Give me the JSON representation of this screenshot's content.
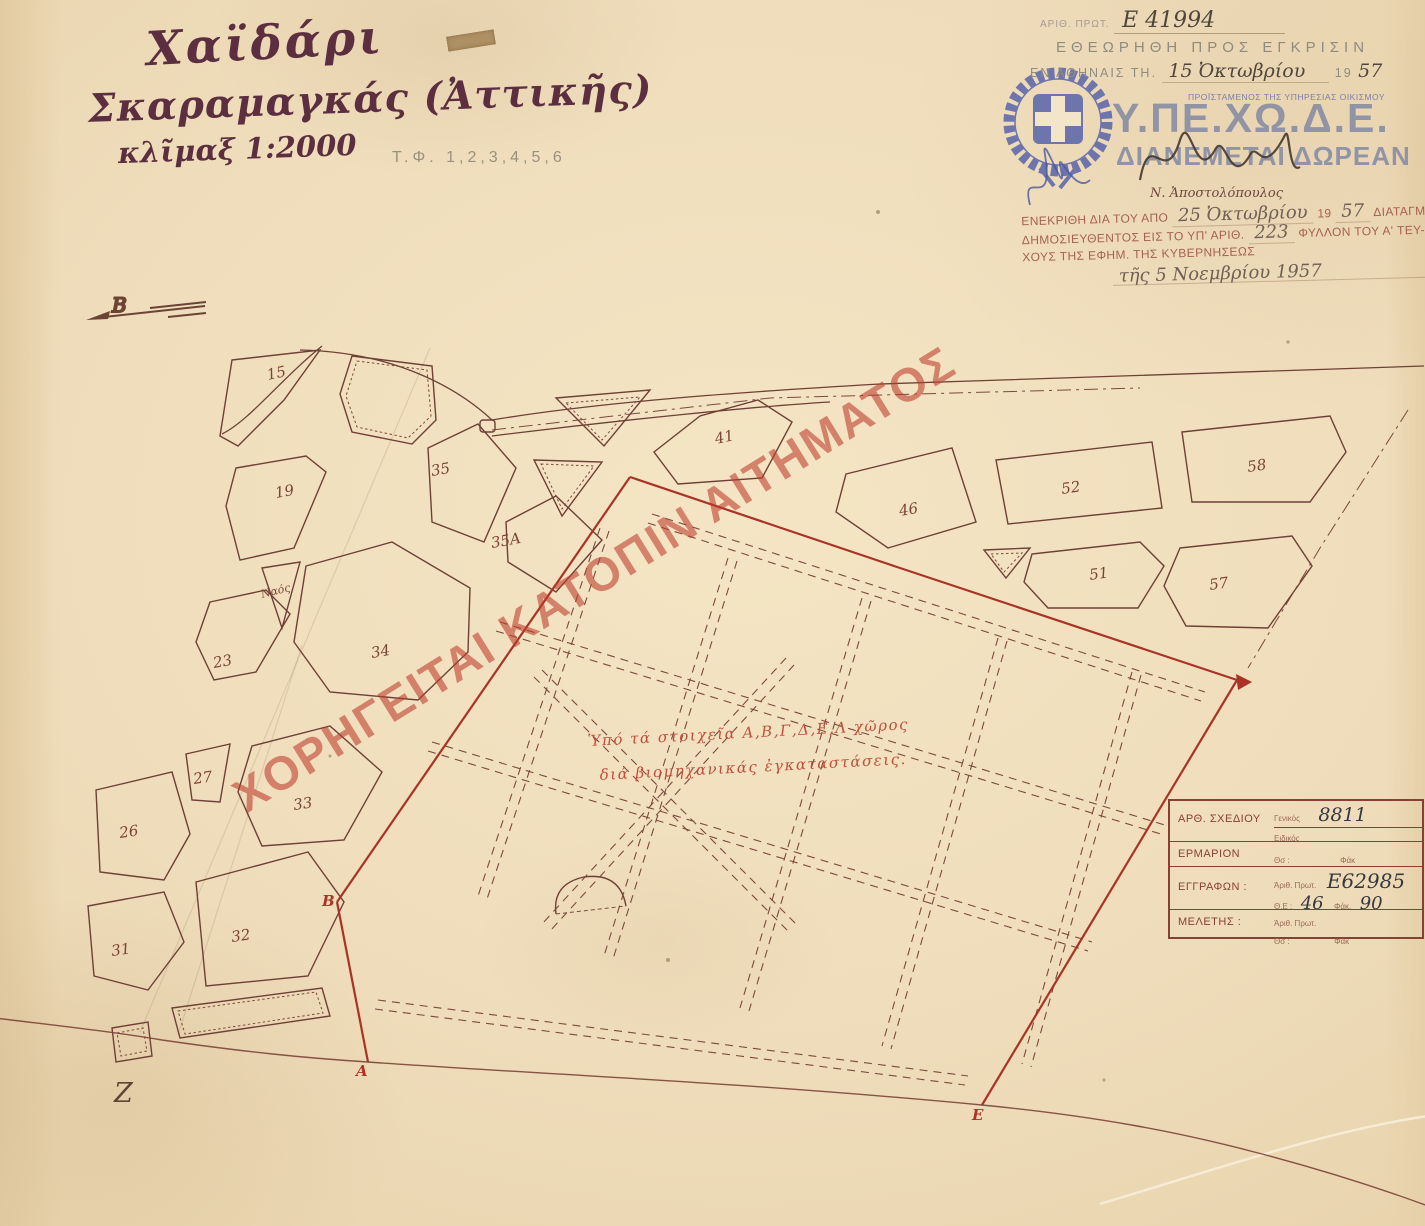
{
  "header": {
    "title_line1": "Χαϊδάρι",
    "title_line2": "Σκαραμαγκάς (Ἀττικῆς)",
    "scale": "κλῖμαξ 1:2000",
    "sheets": "Τ.Φ. 1,2,3,4,5,6"
  },
  "protocol": {
    "number_label": "ΑΡΙΘ. ΠΡΩΤ.",
    "number": "Ε 41994",
    "reviewed": "ΕΘΕΩΡΗΘΗ ΠΡΟΣ ΕΓΚΡΙΣΙΝ",
    "place": "ΕΝ ΑΘΗΝΑΙΣ ΤΗ.",
    "date": "15 Ὀκτωβρίου",
    "year_prefix": "19",
    "year": "57"
  },
  "agency": {
    "role_stamp": "ΠΡΟΪΣΤΑΜΕΝΟΣ ΤΗΣ ΥΠΗΡΕΣΙΑΣ ΟΙΚΙΣΜΟΥ",
    "name": "Υ.ΠΕ.ΧΩ.Δ.Ε.",
    "distribution": "ΔΙΑΝΕΜΕΤΑΙ ΔΩΡΕΑΝ",
    "signer": "Ν. Ἀποστολόπουλος"
  },
  "decree": {
    "line1_a": "ΕΝΕΚΡΙΘΗ ΔΙΑ ΤΟΥ ΑΠΟ",
    "line1_date": "25 Ὀκτωβρίου",
    "line1_c": "19",
    "line1_year": "57",
    "line1_d": "ΔΙΑΤΑΓΜΑΤΟΣ",
    "line2_a": "ΔΗΜΟΣΙΕΥΘΕΝΤΟΣ ΕΙΣ ΤΟ ΥΠ' ΑΡΙΘ.",
    "line2_num": "223",
    "line2_b": "ΦΥΛΛΟΝ ΤΟΥ Α' ΤΕΥ-",
    "line3": "ΧΟΥΣ ΤΗΣ ΕΦΗΜ. ΤΗΣ ΚΥΒΕΡΝΗΣΕΩΣ",
    "line4": "τῆς 5 Νοεμβρίου 1957"
  },
  "watermark": {
    "text": "ΧΟΡΗΓΕΙΤΑΙ ΚΑΤΟΠΙΝ ΑΙΤΗΜΑΤΟΣ",
    "color": "#c03a2e"
  },
  "map": {
    "north_label": "Β",
    "church_label": "Ναός",
    "note_line1": "Ὑπό τά στοιχεῖα Α,Β,Γ,Δ,Ε,Λ χῶρος",
    "note_line2": "διά βιομηχανικάς ἐγκαταστάσεις.",
    "z_label": "Ζ",
    "blocks": [
      "15",
      "19",
      "35",
      "35Α",
      "41",
      "46",
      "52",
      "58",
      "51",
      "57",
      "23",
      "34",
      "26",
      "27",
      "33",
      "31",
      "32"
    ],
    "vertices": [
      "Α",
      "Β",
      "Ε"
    ]
  },
  "registry": {
    "row1_label": "ΑΡΘ. ΣΧΕΔΙΟΥ",
    "row1_sub1": "Γενικός",
    "row1_val1": "8811",
    "row1_sub2": "Ειδικός",
    "row2_label": "ΕΡΜΑΡΙΟΝ",
    "row2_sub1": "Θσ :",
    "row2_sub2": "Φάκ",
    "row3_label": "ΕΓΓΡΑΦΩΝ :",
    "row3_sub1": "Ἀριθ. Πρωτ.",
    "row3_val1": "Ε62985",
    "row3_sub2": "Θ.Ε :",
    "row3_val2": "46",
    "row3_sub3": "Φάκ.",
    "row3_val3": "90",
    "row4_label": "ΜΕΛΕΤΗΣ :",
    "row4_sub1": "Ἀριθ. Πρωτ.",
    "row4_sub2": "Θσ :",
    "row4_sub3": "Φάκ"
  },
  "colors": {
    "paper": "#efdcba",
    "map_ink": "#6e3f35",
    "boundary_red": "#a93327",
    "watermark_red": "#c03a2e",
    "logo_blue": "#5d68ab",
    "stamp_gray": "#8e8b80",
    "agency_bluegray": "#8c91a5"
  }
}
